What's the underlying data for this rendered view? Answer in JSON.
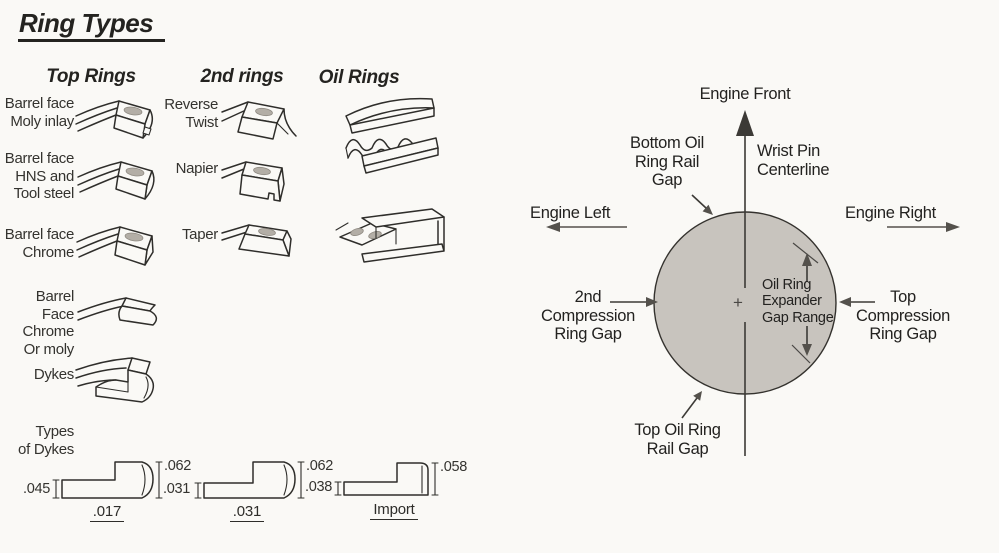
{
  "colors": {
    "paper": "#faf9f6",
    "ink": "#2b2a27",
    "piston": "#c8c4be",
    "dot": "#b3aea6",
    "arrow": "#54514c"
  },
  "title": "Ring Types",
  "left": {
    "top_rings": {
      "header": "Top Rings",
      "items": [
        {
          "label": "Barrel face\nMoly inlay"
        },
        {
          "label": "Barrel face\nHNS and\nTool steel"
        },
        {
          "label": "Barrel face\nChrome"
        },
        {
          "label": "Barrel Face\nChrome\nOr moly"
        },
        {
          "label": "Dykes"
        },
        {
          "label": "Types\nof Dykes"
        }
      ]
    },
    "second_rings": {
      "header": "2nd rings",
      "items": [
        {
          "label": "Reverse\nTwist"
        },
        {
          "label": "Napier"
        },
        {
          "label": "Taper"
        }
      ]
    },
    "oil_rings": {
      "header": "Oil Rings"
    }
  },
  "cross_sections": [
    {
      "left_dim": ".045",
      "right_dim": ".062",
      "label": ".017"
    },
    {
      "left_dim": ".031",
      "right_dim": ".062",
      "label": ".031"
    },
    {
      "left_dim": ".038",
      "right_dim": ".058",
      "label": "Import"
    }
  ],
  "gap_diagram": {
    "engine_front": "Engine Front",
    "engine_left": "Engine Left",
    "engine_right": "Engine Right",
    "wrist_pin": "Wrist Pin\nCenterline",
    "bottom_oil_gap": "Bottom Oil\nRing Rail\nGap",
    "second_compression_gap": "2nd\nCompression\nRing Gap",
    "top_compression_gap": "Top\nCompression\nRing Gap",
    "oil_expander_gap": "Oil Ring\nExpander\nGap Range",
    "top_oil_gap": "Top Oil Ring\nRail Gap",
    "center_mark": "+"
  }
}
